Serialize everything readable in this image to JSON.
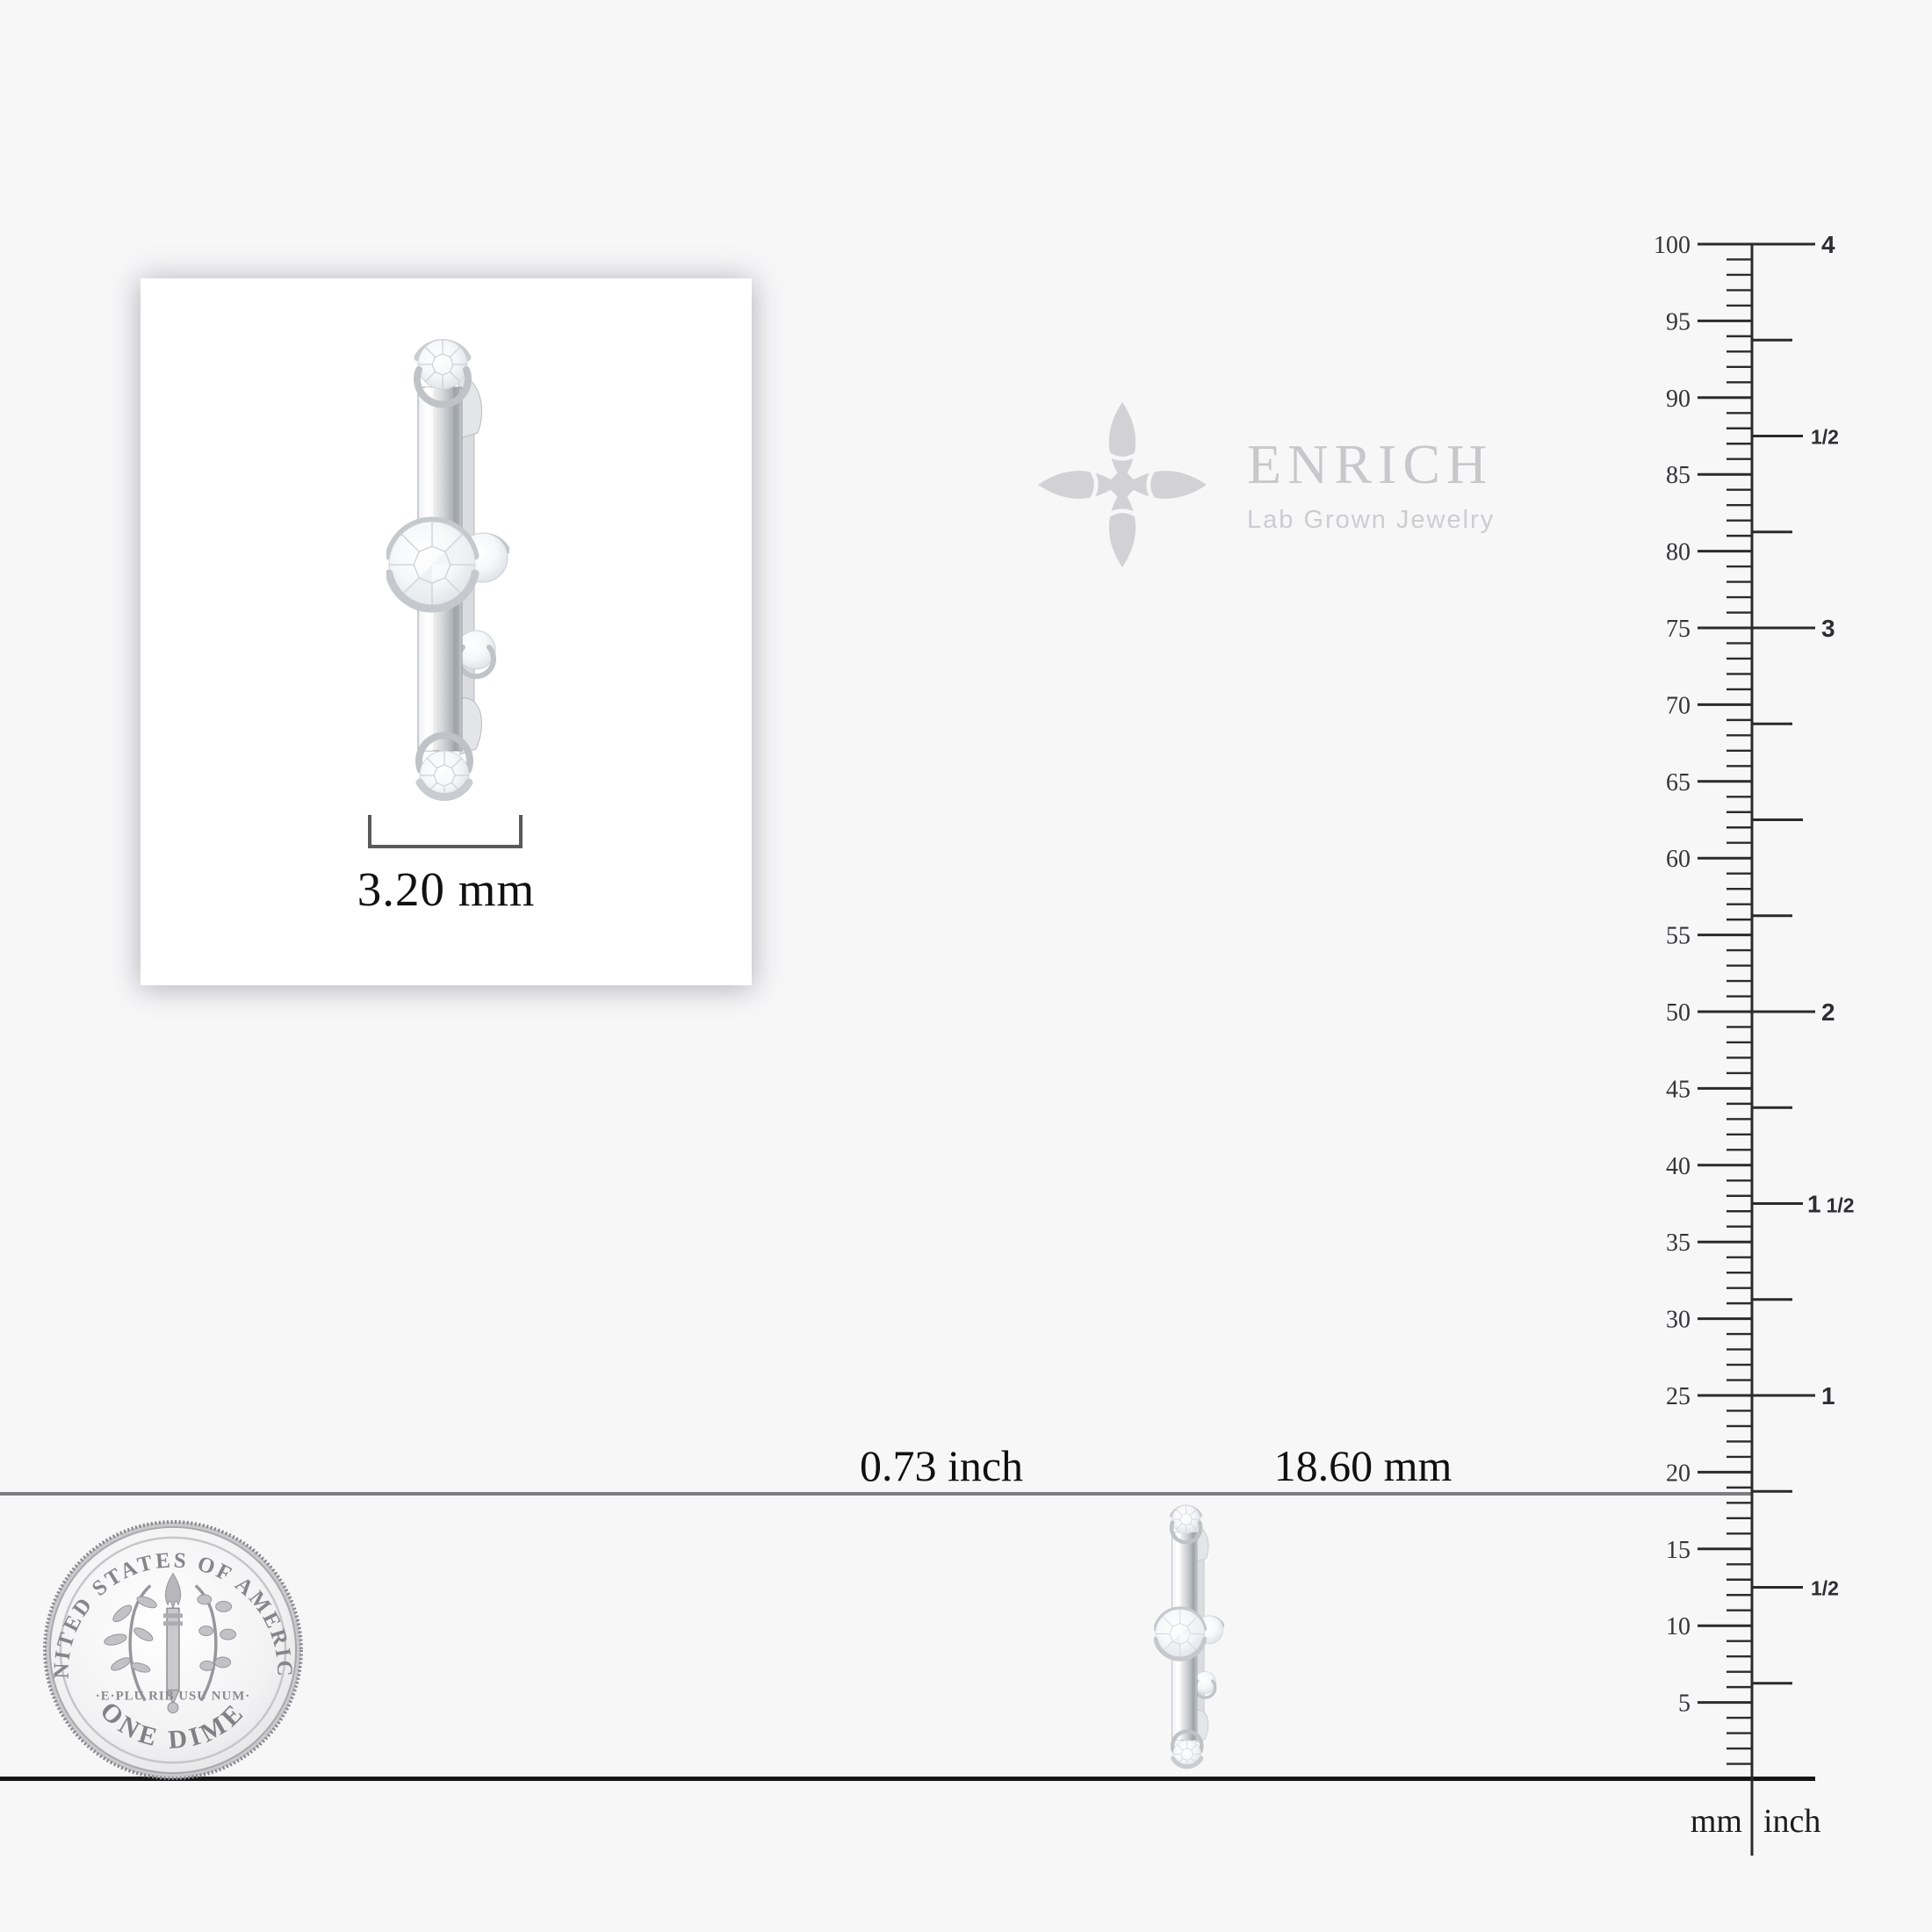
{
  "page": {
    "background": "#f7f7f8"
  },
  "product_card": {
    "width_label": "3.20 mm"
  },
  "watermark": {
    "brand": "ENRICH",
    "tagline": "Lab Grown Jewelry"
  },
  "comparison": {
    "inch_label": "0.73 inch",
    "mm_label": "18.60 mm"
  },
  "coin": {
    "top_text": "UNITED STATES OF AMERICA",
    "middle_text": "·E·PLU RIB USU NUM·",
    "bottom_text": "ONE DIME"
  },
  "ruler": {
    "unit_left": "mm",
    "unit_right": "inch",
    "mm_max": 100,
    "mm_label_step": 5,
    "mm_labels": [
      100,
      95,
      90,
      85,
      80,
      75,
      70,
      65,
      60,
      55,
      50,
      45,
      40,
      35,
      30,
      25,
      20,
      15,
      10,
      5
    ],
    "inch_max": 4,
    "inch_ticks_per_inch": 4,
    "inch_labels": [
      {
        "inch": 4,
        "text": "4"
      },
      {
        "inch": 3.5,
        "text": "1/2"
      },
      {
        "inch": 3,
        "text": "3"
      },
      {
        "inch": 2,
        "text": "2"
      },
      {
        "inch": 1.5,
        "text": "1 1/2"
      },
      {
        "inch": 1,
        "text": "1"
      },
      {
        "inch": 0.5,
        "text": "1/2"
      }
    ]
  }
}
